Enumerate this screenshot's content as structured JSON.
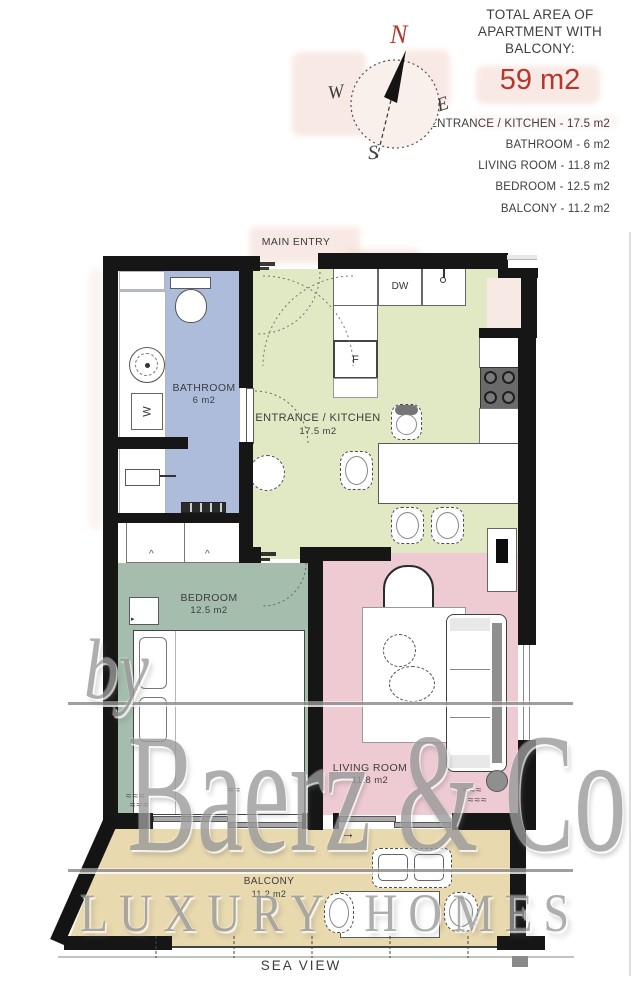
{
  "colors": {
    "wall": "#161616",
    "accent_red": "#b5372e",
    "watermark_gray": "#9a9a9a",
    "line_gray": "#8f8f8f"
  },
  "legend": {
    "title": "TOTAL AREA OF APARTMENT WITH BALCONY:",
    "total": "59 m2",
    "items": [
      "ENTRANCE / KITCHEN - 17.5 m2",
      "BATHROOM - 6 m2",
      "LIVING ROOM - 11.8 m2",
      "BEDROOM - 12.5 m2",
      "BALCONY - 11.2 m2"
    ]
  },
  "compass": {
    "n": "N",
    "e": "E",
    "s": "S",
    "w": "W"
  },
  "plan": {
    "entry_label": "MAIN ENTRY",
    "sea_view": "SEA VIEW",
    "rooms": {
      "bathroom": {
        "name": "BATHROOM",
        "area": "6 m2",
        "color": "#adbcda"
      },
      "kitchen": {
        "name": "ENTRANCE / KITCHEN",
        "area": "17.5 m2",
        "color": "#e0e8c4"
      },
      "bedroom": {
        "name": "BEDROOM",
        "area": "12.5 m2",
        "color": "#a4bdac"
      },
      "living": {
        "name": "LIVING ROOM",
        "area": "11.8 m2",
        "color": "#eecbd2"
      },
      "balcony": {
        "name": "BALCONY",
        "area": "11.2 m2",
        "color": "#e9d9ae"
      }
    },
    "appliances": {
      "dishwasher": "DW",
      "fridge": "F",
      "washer": "W"
    }
  },
  "watermark": {
    "by": "by",
    "brand": "Baerz & Co",
    "tagline": "LUXURY HOMES"
  },
  "glyphs": {
    "arrow_right": "→",
    "squiggle": "≈≈≈",
    "squiggle_small": "≈≈",
    "caret": "^",
    "pointer": "▸"
  }
}
